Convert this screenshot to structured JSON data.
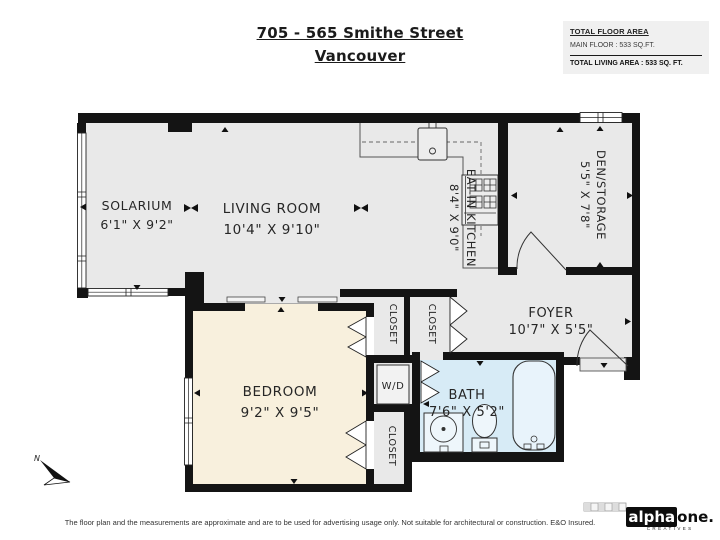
{
  "header": {
    "title_line1": "705 - 565 Smithe Street",
    "title_line2": "Vancouver"
  },
  "info_box": {
    "heading": "TOTAL FLOOR AREA",
    "main_floor": "MAIN FLOOR : 533 SQ.FT.",
    "total": "TOTAL LIVING AREA : 533 SQ. FT."
  },
  "rooms": {
    "solarium": {
      "name": "SOLARIUM",
      "dims": "6'1\" X 9'2\""
    },
    "living": {
      "name": "LIVING ROOM",
      "dims": "10'4\" X 9'10\""
    },
    "kitchen": {
      "name": "EAT-IN KITCHEN",
      "dims": "8'4\" X 9'0\""
    },
    "den": {
      "name": "DEN/STORAGE",
      "dims": "5'5\" X 7'8\""
    },
    "foyer": {
      "name": "FOYER",
      "dims": "10'7\" X 5'5\""
    },
    "bedroom": {
      "name": "BEDROOM",
      "dims": "9'2\" X 9'5\""
    },
    "bath": {
      "name": "BATH",
      "dims": "7'6\" X 5'2\""
    },
    "closet1": "CLOSET",
    "closet2": "CLOSET",
    "closet3": "CLOSET",
    "laundry": "W/D"
  },
  "compass": {
    "north": "N"
  },
  "footer": {
    "disclaimer": "The floor plan and the measurements are approximate and are to be used for advertising usage only. Not suitable for architectural or construction. E&O Insured."
  },
  "logo": {
    "part1": "alpha",
    "part2": "one.",
    "tagline": "CREATIVES"
  },
  "colors": {
    "wall": "#141414",
    "floor": "#e9e9e9",
    "bedroom_floor": "#f8f0dd",
    "bath_floor": "#d7ebf6",
    "fixture_fill": "#eef6fb",
    "info_box_bg": "#f0f0f0"
  }
}
